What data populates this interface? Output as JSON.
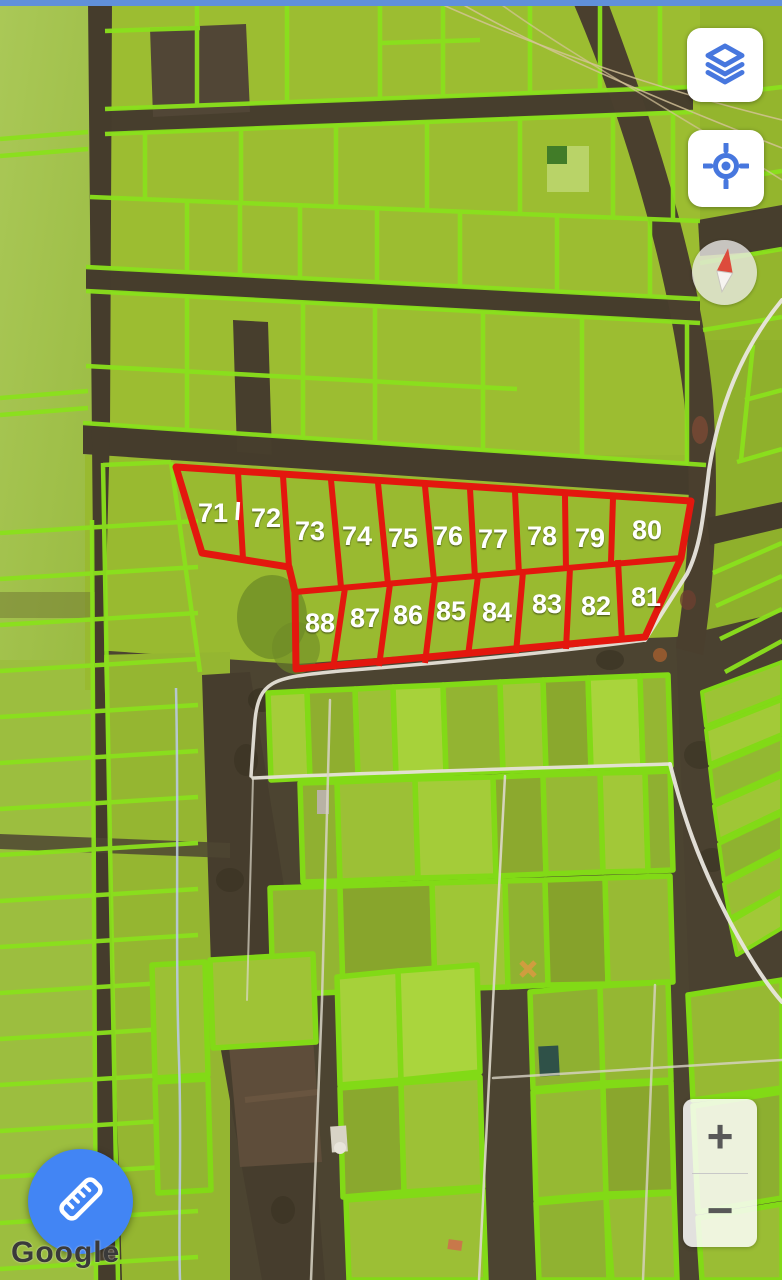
{
  "parcels": {
    "labels": [
      "71",
      "72",
      "73",
      "74",
      "75",
      "76",
      "77",
      "78",
      "79",
      "80",
      "81",
      "82",
      "83",
      "84",
      "85",
      "86",
      "87",
      "88"
    ],
    "outline_color": "#e3170e",
    "label_color": "#ffffff"
  },
  "overlay": {
    "cadastre_grid_color": "#8ae11c"
  },
  "controls": {
    "layers": {
      "icon": "layers-icon",
      "color": "#4777de"
    },
    "locate": {
      "icon": "my-location-icon",
      "color": "#4777de"
    },
    "compass": {
      "icon": "compass-needle-icon",
      "needle_color": "#dd4b3c"
    },
    "zoom_in_label": "+",
    "zoom_out_label": "−",
    "measure": {
      "icon": "ruler-icon",
      "color": "#4285F4"
    }
  },
  "attribution": {
    "text": "Google"
  }
}
